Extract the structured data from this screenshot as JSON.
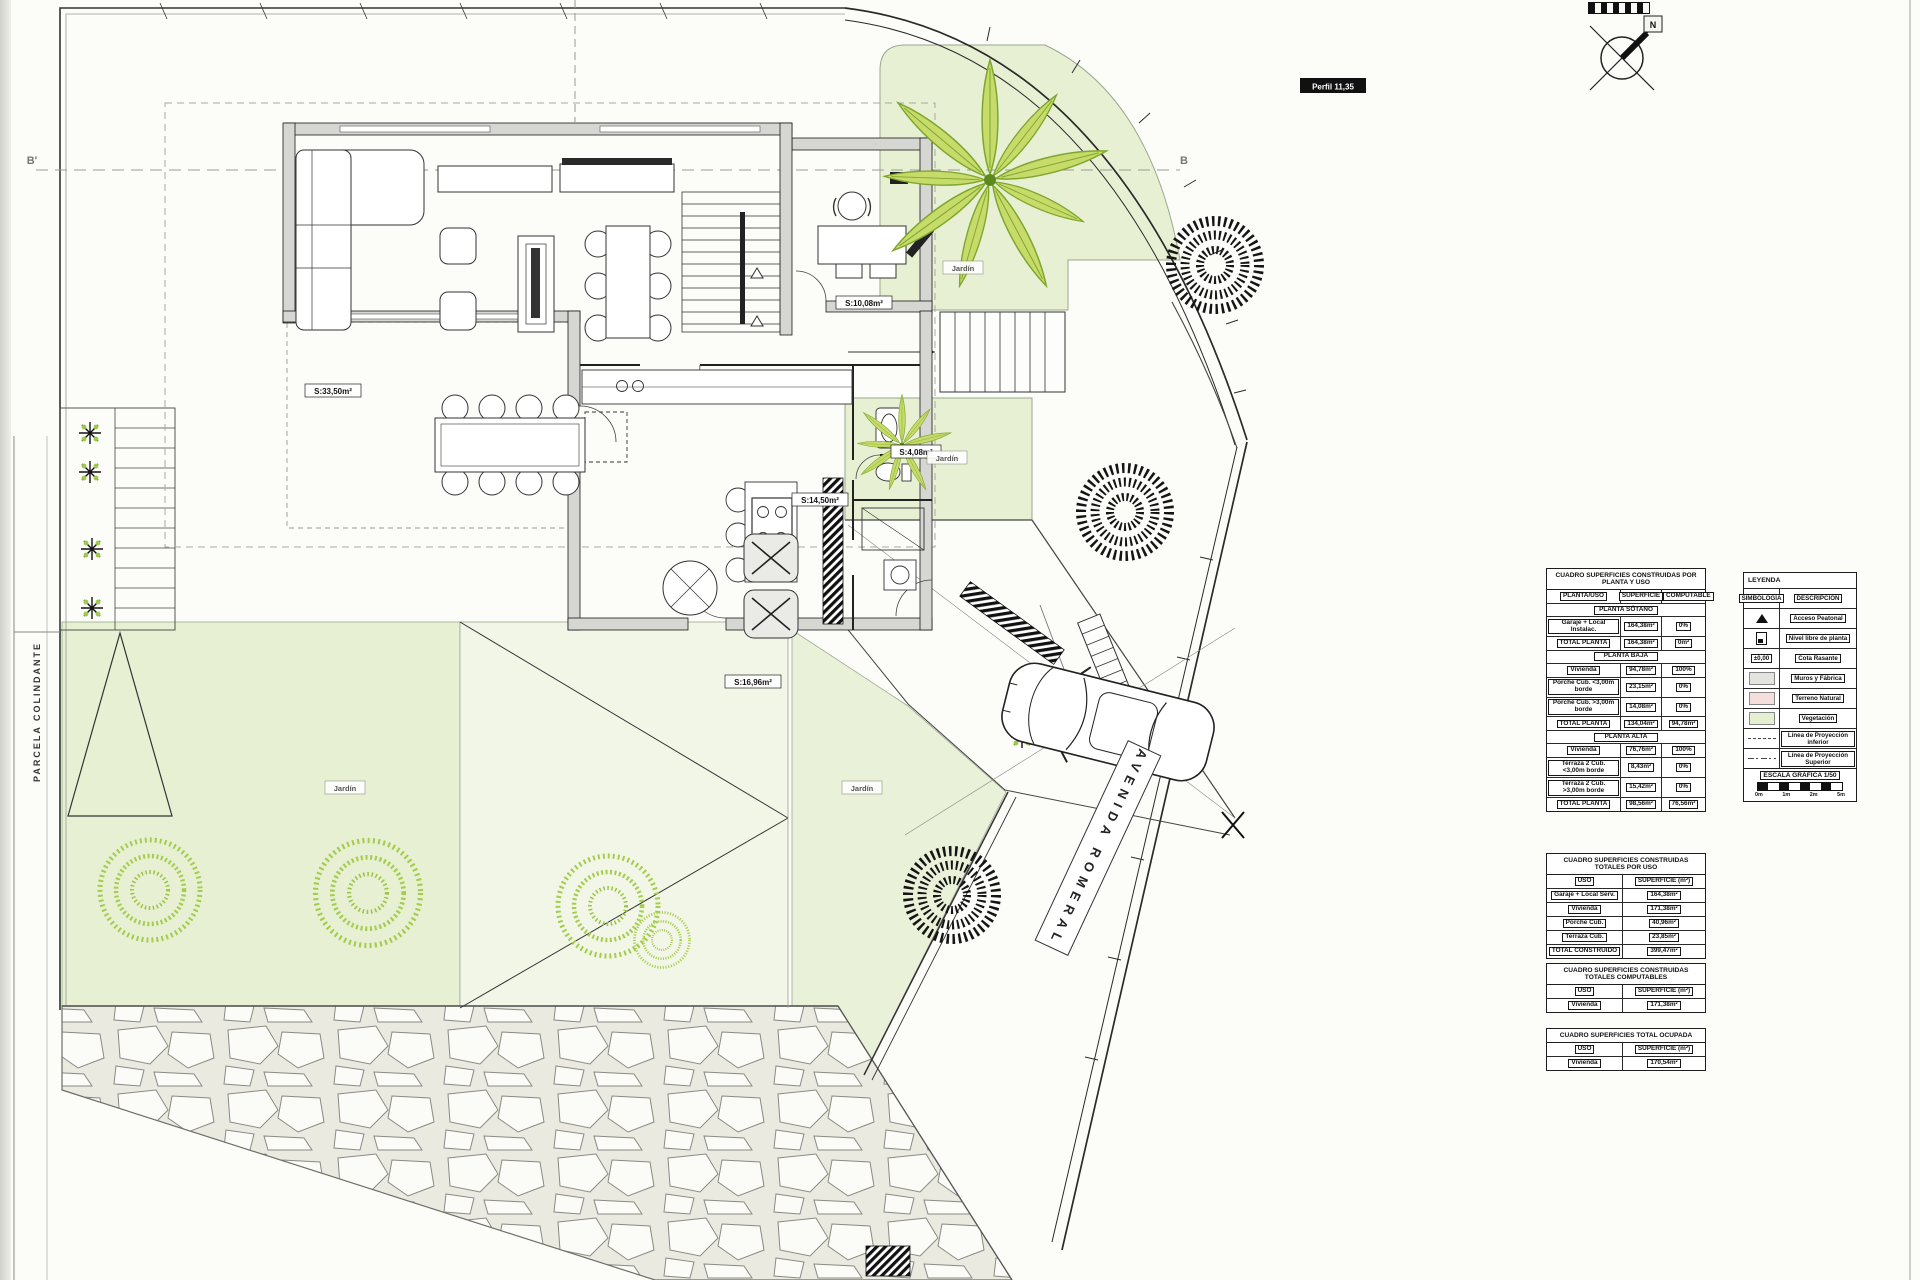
{
  "labels": {
    "porche": "S:33,50m²",
    "despacho": "S:10,08m²",
    "cocina": "S:14,50m²",
    "terraza": "S:16,96m²",
    "aseo": "S:4,08m²",
    "jardin": "Jardín",
    "perfil": "Perfil 11,35",
    "parcela": "PARCELA COLINDANTE",
    "avenida": "AVENIDA ROMERAL",
    "b_left": "B'",
    "b_right": "B",
    "north": "N"
  },
  "tables": {
    "t1": {
      "title": "CUADRO SUPERFICIES CONSTRUIDAS POR PLANTA Y USO",
      "headers": [
        "PLANTA/USO",
        "SUPERFICIE",
        "COMPUTABLE"
      ],
      "sections": [
        {
          "name": "PLANTA SÓTANO",
          "rows": [
            {
              "label": "Garaje + Local Instalac.",
              "sup": "164,38m²",
              "comp": "0%"
            },
            {
              "label": "TOTAL PLANTA",
              "sup": "164,38m²",
              "comp": "0m²"
            }
          ]
        },
        {
          "name": "PLANTA BAJA",
          "rows": [
            {
              "label": "Vivienda",
              "sup": "94,78m²",
              "comp": "100%"
            },
            {
              "label": "Porche Cub. <3,00m borde",
              "sup": "23,15m²",
              "comp": "0%"
            },
            {
              "label": "Porche Cub. >3,00m borde",
              "sup": "14,08m²",
              "comp": "0%"
            },
            {
              "label": "TOTAL PLANTA",
              "sup": "134,04m²",
              "comp": "94,78m²"
            }
          ]
        },
        {
          "name": "PLANTA ALTA",
          "rows": [
            {
              "label": "Vivienda",
              "sup": "76,76m²",
              "comp": "100%"
            },
            {
              "label": "Terraza 2 Cub. <3,00m borde",
              "sup": "8,43m²",
              "comp": "0%"
            },
            {
              "label": "Terraza 2 Cub. >3,00m borde",
              "sup": "15,42m²",
              "comp": "0%"
            },
            {
              "label": "TOTAL PLANTA",
              "sup": "98,56m²",
              "comp": "76,56m²"
            }
          ]
        }
      ]
    },
    "t2": {
      "title": "CUADRO SUPERFICIES CONSTRUIDAS TOTALES POR USO",
      "headers": [
        "USO",
        "SUPERFICIE (m²)"
      ],
      "rows": [
        {
          "label": "Garaje + Local Serv.",
          "sup": "164,38m²"
        },
        {
          "label": "Vivienda",
          "sup": "171,38m²"
        },
        {
          "label": "Porche Cub.",
          "sup": "40,96m²"
        },
        {
          "label": "Terraza Cub.",
          "sup": "23,85m²"
        },
        {
          "label": "TOTAL CONSTRUIDO",
          "sup": "399,47m²"
        }
      ]
    },
    "t3": {
      "title": "CUADRO SUPERFICIES CONSTRUIDAS TOTALES COMPUTABLES",
      "headers": [
        "USO",
        "SUPERFICIE (m²)"
      ],
      "rows": [
        {
          "label": "Vivienda",
          "sup": "171,38m²"
        }
      ]
    },
    "t4": {
      "title": "CUADRO SUPERFICIES TOTAL OCUPADA",
      "headers": [
        "USO",
        "SUPERFICIE (m²)"
      ],
      "rows": [
        {
          "label": "Vivienda",
          "sup": "170,54m²"
        }
      ]
    }
  },
  "legend": {
    "title": "LEYENDA",
    "headers": [
      "SIMBOLOGÍA",
      "DESCRIPCIÓN"
    ],
    "cota": "±0,00",
    "rows": [
      {
        "desc": "Acceso Peatonal"
      },
      {
        "desc": "Nivel libre de planta"
      },
      {
        "desc": "Cota Rasante"
      },
      {
        "desc": "Muros y Fábrica"
      },
      {
        "desc": "Terreno Natural"
      },
      {
        "desc": "Vegetación"
      },
      {
        "desc": "Línea de Proyección inferior"
      },
      {
        "desc": "Línea de Proyección Superior"
      }
    ]
  },
  "scale": {
    "title": "ESCALA GRÁFICA 1/50",
    "ticks": [
      "0m",
      "1m",
      "2m",
      "5m"
    ]
  }
}
